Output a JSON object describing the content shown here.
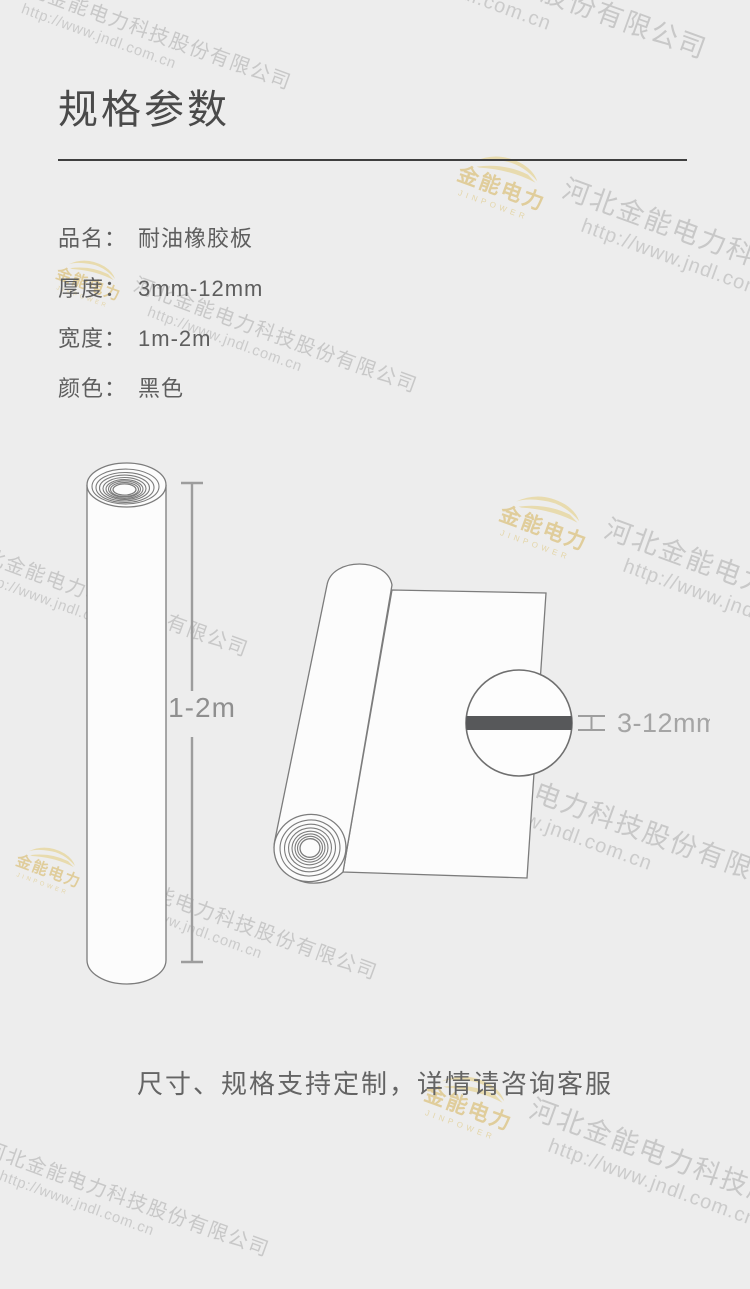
{
  "page": {
    "background": "#ededed"
  },
  "header": {
    "title": "规格参数"
  },
  "specs": [
    {
      "label": "品名：",
      "value": "耐油橡胶板"
    },
    {
      "label": "厚度：",
      "value": "3mm-12mm"
    },
    {
      "label": "宽度：",
      "value": "1m-2m"
    },
    {
      "label": "颜色：",
      "value": "黑色"
    }
  ],
  "figures": {
    "roll_length_label": "1-2m",
    "thickness_label": "3-12mm"
  },
  "note": "尺寸、规格支持定制，详情请咨询客服",
  "watermark": {
    "company": "河北金能电力科技股份有限公司",
    "url": "http://www.jndl.com.cn",
    "logo_text": "金能电力",
    "logo_sub": "JINPOWER"
  },
  "colors": {
    "divider": "#3f3f3f",
    "outline": "#7c7c7c",
    "shape_fill": "#fcfcfc",
    "thickness_bar": "#57585a",
    "dimension_gray": "#9d9d9d",
    "logo_gold": "#e6d8ab"
  }
}
